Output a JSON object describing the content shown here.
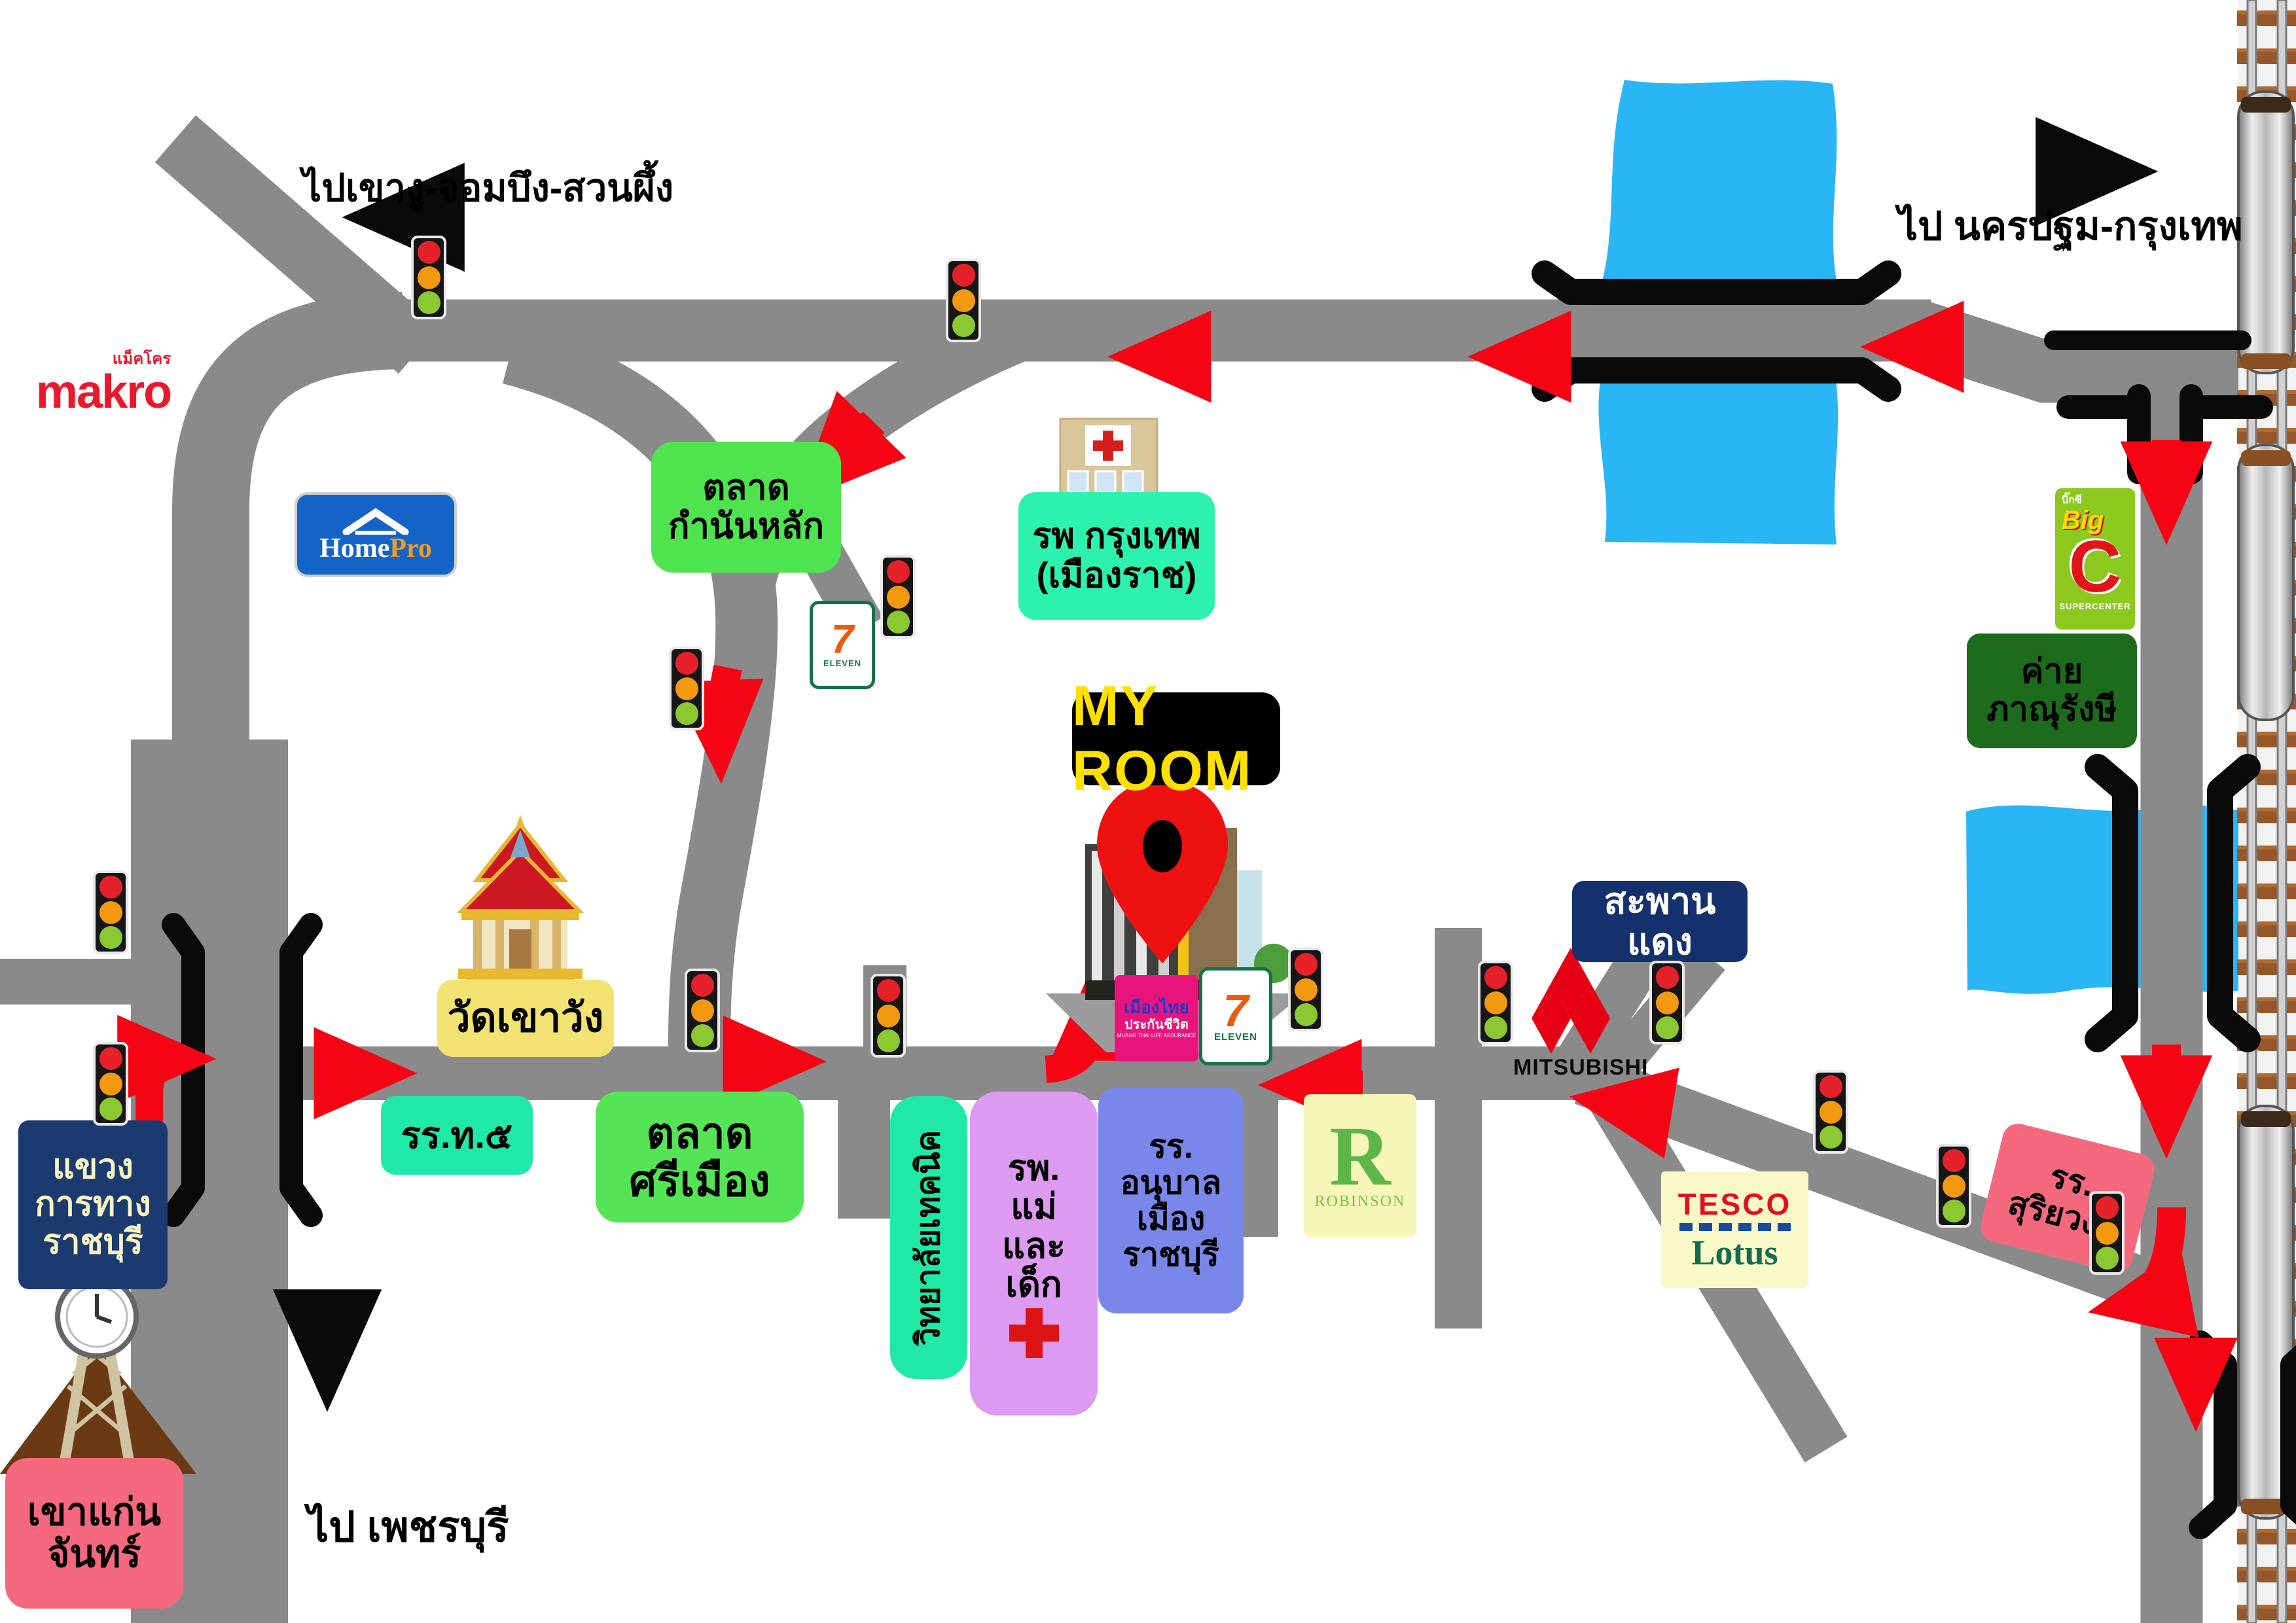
{
  "direction_notes": {
    "northwest": "ไปเขางู-จอมบึง-สวนผึ้ง",
    "northeast": "ไป นครปฐม-กรุงเทพ",
    "south": "ไป เพชรบุรี"
  },
  "destination": {
    "label": "MY ROOM"
  },
  "places": {
    "talat_kamnan_lak": {
      "line1": "ตลาด",
      "line2": "กำนันหลัก"
    },
    "bangkok_hospital": {
      "line1": "รพ กรุงเทพ",
      "line2": "(เมืองราช)"
    },
    "wat_khao_wang": {
      "label": "วัดเขาวัง"
    },
    "saphan_daeng": {
      "label": "สะพานแดง"
    },
    "highway_district": {
      "line1": "แขวง",
      "line2": "การทาง",
      "line3": "ราชบุรี"
    },
    "khao_kaen_chan": {
      "line1": "เขาแก่น",
      "line2": "จันทร์"
    },
    "school_t5": {
      "label": "รร.ท.๕"
    },
    "talat_si_mueang": {
      "line1": "ตลาด",
      "line2": "ศรีเมือง"
    },
    "technical_college": {
      "label": "วิทยาลัยเทคนิค"
    },
    "mother_child_hospital": {
      "line1": "รพ.",
      "line2": "แม่",
      "line3": "และ",
      "line4": "เด็ก"
    },
    "anuban_school": {
      "line1": "รร.",
      "line2": "อนุบาล",
      "line3": "เมือง",
      "line4": "ราชบุรี"
    },
    "phanurangsi_camp": {
      "line1": "ค่าย",
      "line2": "ภาณุรังษี"
    },
    "suriyawong_school": {
      "line1": "รร.",
      "line2": "สุริยวงศ์"
    }
  },
  "logos": {
    "makro": {
      "name": "makro",
      "thai": "แม็คโคร"
    },
    "homepro": {
      "home": "Home",
      "pro": "Pro"
    },
    "seven_eleven": {
      "seven": "7",
      "eleven": "ELEVEN"
    },
    "big_c": {
      "thai": "บิ๊กซี",
      "big": "Big",
      "c": "C",
      "sub": "SUPERCENTER"
    },
    "tesco_lotus": {
      "tesco": "TESCO",
      "lotus": "Lotus"
    },
    "robinson": {
      "r": "R",
      "name": "ROBINSON"
    },
    "mitsubishi": {
      "name": "MITSUBISHI"
    },
    "muang_thai": {
      "line1": "เมืองไทย",
      "line2": "ประกันชีวิต",
      "line3": "MUANG THAI LIFE ASSURANCE"
    }
  },
  "colors": {
    "road": "#8a8a8a",
    "river": "#2ab5f5",
    "route_arrow": "#f50514",
    "label_green": "#4fe44f",
    "label_spring": "#2df2ae",
    "label_yellow": "#f2e272",
    "label_navy": "#14316e",
    "label_pink": "#f4697e",
    "label_violet": "#dc9af0",
    "label_blue_violet": "#7a87ea",
    "camp_green": "#1d6b1d"
  }
}
